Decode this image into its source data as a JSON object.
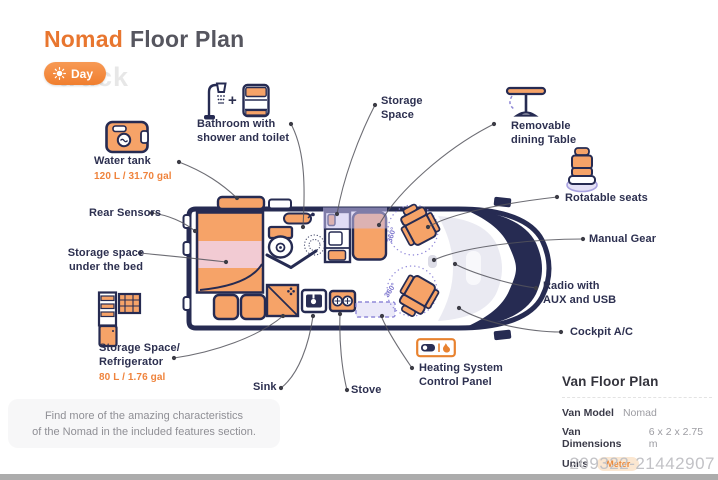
{
  "colors": {
    "accent_orange": "#E8762F",
    "navy": "#2D3050",
    "furniture_orange": "#F6A368",
    "bed_storage_pink": "#F2CBD3",
    "highlight_lavender": "#C6C0EE",
    "toggle_orange": "#F07E2E"
  },
  "header": {
    "title_accent": "Nomad",
    "title_rest": "Floor Plan",
    "day_toggle": "Day",
    "bg_watermark": "truck"
  },
  "labels": {
    "water_tank": {
      "title": "Water tank",
      "capacity": "120 L / 31.70 gal"
    },
    "rear_sensors": {
      "title": "Rear Sensors"
    },
    "storage_bed": {
      "line1": "Storage space",
      "line2": "under the bed"
    },
    "fridge": {
      "line1": "Storage Space/",
      "line2": "Refrigerator",
      "capacity": "80 L / 1.76 gal"
    },
    "bathroom": {
      "line1": "Bathroom with",
      "line2": "shower and toilet",
      "plus": "+"
    },
    "storage_space": {
      "line1": "Storage",
      "line2": "Space"
    },
    "dining_table": {
      "line1": "Removable",
      "line2": "dining Table"
    },
    "rotatable_seats": {
      "title": "Rotatable seats"
    },
    "manual_gear": {
      "title": "Manual Gear"
    },
    "radio": {
      "line1": "Radio with",
      "line2": "AUX and USB"
    },
    "cockpit_ac": {
      "title": "Cockpit A/C"
    },
    "sink": {
      "title": "Sink"
    },
    "stove": {
      "title": "Stove"
    },
    "heating": {
      "line1": "Heating System",
      "line2": "Control Panel"
    }
  },
  "floorplan": {
    "rotation_label": "360°"
  },
  "info_panel": {
    "title": "Van Floor Plan",
    "rows": [
      {
        "label": "Van Model",
        "value": "Nomad"
      },
      {
        "label": "Van Dimensions",
        "value": "6 x 2 x 2.75 m"
      },
      {
        "label": "Units",
        "value": "Meter"
      }
    ]
  },
  "note": {
    "line1": "Find more of the amazing characteristics",
    "line2": "of the Nomad in the included features section."
  },
  "footer": {
    "watermark": "209322-21442907"
  }
}
